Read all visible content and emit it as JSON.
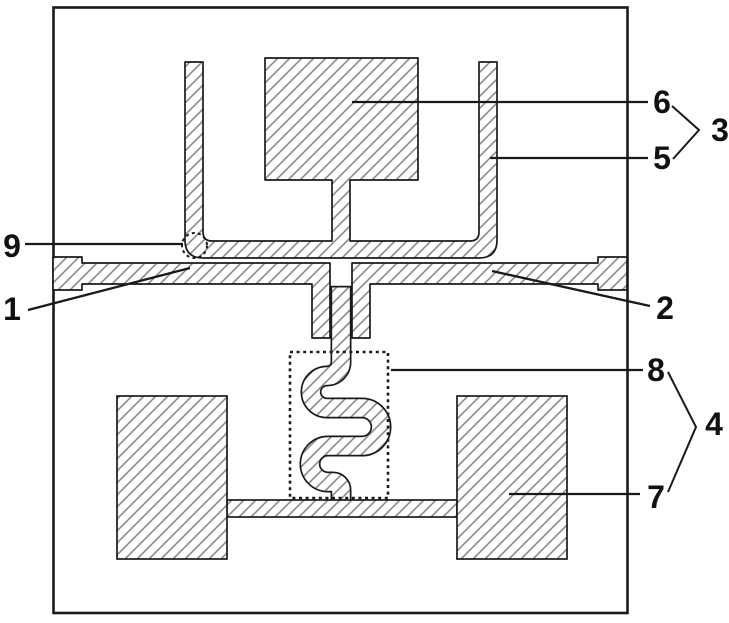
{
  "figure": {
    "description": "Patent-style technical diagram of a micro-device: upper U-shaped hatched arm with central block, middle anchored beam, serpentine spring in dotted box, two bottom hatched pads",
    "colors": {
      "background": "#ffffff",
      "outline": "#1a1a1a",
      "hatch": "#8b8b8b",
      "label": "#111111"
    },
    "labels": [
      {
        "text": "9",
        "x": 12,
        "y": 246,
        "leader": [
          [
            25,
            244
          ],
          [
            183,
            244
          ]
        ]
      },
      {
        "text": "1",
        "x": 12,
        "y": 309,
        "leader": [
          [
            28,
            310
          ],
          [
            190,
            268
          ]
        ]
      },
      {
        "text": "6",
        "x": 662,
        "y": 102,
        "leader": [
          [
            352,
            102
          ],
          [
            648,
            102
          ]
        ]
      },
      {
        "text": "5",
        "x": 662,
        "y": 158,
        "leader": [
          [
            490,
            158
          ],
          [
            648,
            158
          ]
        ]
      },
      {
        "text": "3",
        "x": 720,
        "y": 130,
        "chevron": [
          [
            672,
            106
          ],
          [
            699,
            130
          ],
          [
            673,
            159
          ]
        ]
      },
      {
        "text": "2",
        "x": 665,
        "y": 308,
        "leader": [
          [
            492,
            271
          ],
          [
            650,
            306
          ]
        ]
      },
      {
        "text": "8",
        "x": 656,
        "y": 370,
        "leader": [
          [
            391,
            370
          ],
          [
            643,
            370
          ]
        ]
      },
      {
        "text": "4",
        "x": 714,
        "y": 424,
        "chevron": [
          [
            668,
            372
          ],
          [
            696,
            427
          ],
          [
            668,
            492
          ]
        ]
      },
      {
        "text": "7",
        "x": 656,
        "y": 497,
        "leader": [
          [
            509,
            494
          ],
          [
            640,
            494
          ]
        ]
      }
    ]
  }
}
